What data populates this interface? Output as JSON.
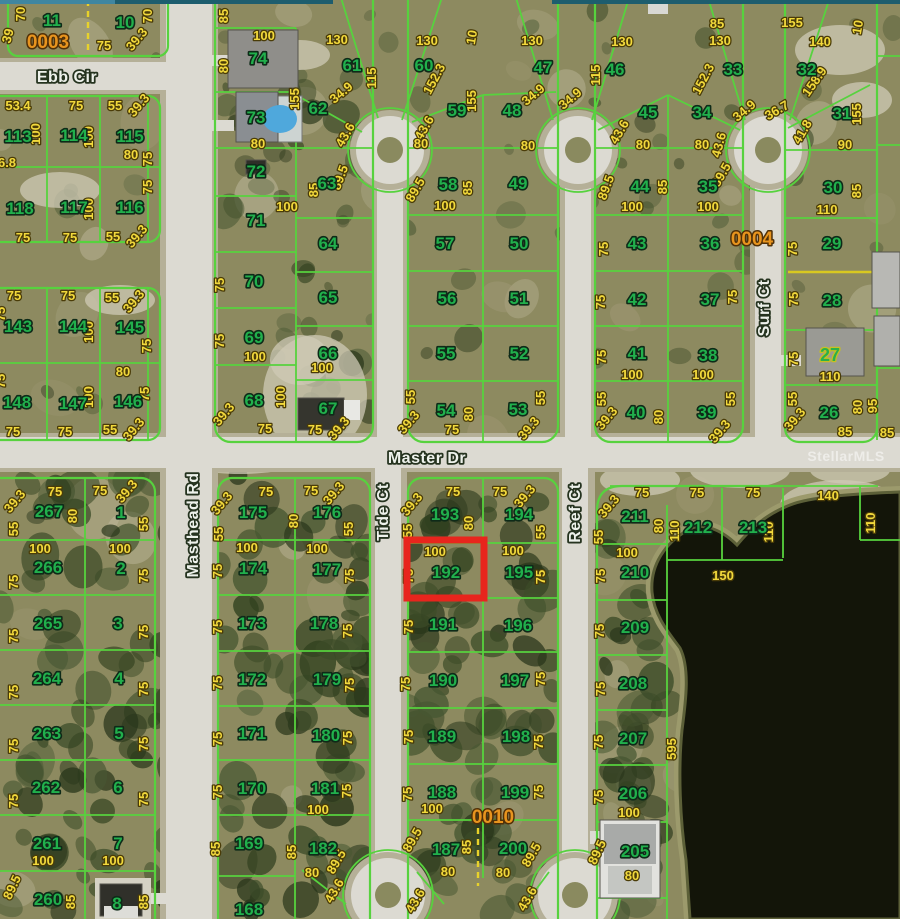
{
  "colors": {
    "lot_number": "#21b04c",
    "dimension": "#f2d93c",
    "street_label": "#eef2ec",
    "section_label": "#e8941e",
    "parcel_line": "#57d23e",
    "highlight": "#e8251d",
    "road": "#dcdad2",
    "water": "#131509",
    "ground": "#8d8a60",
    "pool": "#4fa8dc"
  },
  "watermark": {
    "text": "StellarMLS",
    "x": 846,
    "y": 461
  },
  "highlight": {
    "lot": "192",
    "x": 407,
    "y": 540,
    "w": 77,
    "h": 58
  },
  "streets": [
    {
      "name": "Ebb Cir",
      "x": 67,
      "y": 82,
      "rot": 0,
      "size": 17
    },
    {
      "name": "Masthead Rd",
      "x": 198,
      "y": 525,
      "rot": -90,
      "size": 16
    },
    {
      "name": "Master Dr",
      "x": 427,
      "y": 463,
      "rot": 0,
      "size": 18
    },
    {
      "name": "Tide Ct",
      "x": 388,
      "y": 512,
      "rot": -90,
      "size": 15
    },
    {
      "name": "Reef Ct",
      "x": 580,
      "y": 513,
      "rot": -90,
      "size": 15
    },
    {
      "name": "Surf Ct",
      "x": 769,
      "y": 308,
      "rot": -90,
      "size": 15
    }
  ],
  "sections": [
    [
      "0003",
      48,
      48
    ],
    [
      "0004",
      752,
      245
    ],
    [
      "0010",
      493,
      823
    ]
  ],
  "lots": [
    [
      "11",
      52,
      26
    ],
    [
      "10",
      125,
      28
    ],
    [
      "113",
      18,
      142
    ],
    [
      "114",
      74,
      141
    ],
    [
      "115",
      130,
      142
    ],
    [
      "118",
      20,
      214
    ],
    [
      "117",
      74,
      213
    ],
    [
      "116",
      130,
      213
    ],
    [
      "143",
      18,
      332
    ],
    [
      "144",
      73,
      332
    ],
    [
      "145",
      130,
      333
    ],
    [
      "148",
      17,
      408
    ],
    [
      "147",
      73,
      409
    ],
    [
      "146",
      128,
      407
    ],
    [
      "74",
      258,
      64
    ],
    [
      "73",
      256,
      123
    ],
    [
      "72",
      256,
      177
    ],
    [
      "71",
      256,
      226
    ],
    [
      "70",
      254,
      287
    ],
    [
      "69",
      254,
      343
    ],
    [
      "68",
      254,
      406
    ],
    [
      "61",
      352,
      71
    ],
    [
      "62",
      318,
      114
    ],
    [
      "63",
      327,
      189
    ],
    [
      "64",
      328,
      249
    ],
    [
      "65",
      328,
      303
    ],
    [
      "66",
      328,
      359
    ],
    [
      "67",
      328,
      414
    ],
    [
      "60",
      424,
      71
    ],
    [
      "59",
      457,
      116
    ],
    [
      "58",
      448,
      190
    ],
    [
      "57",
      445,
      249
    ],
    [
      "56",
      447,
      304
    ],
    [
      "55",
      446,
      359
    ],
    [
      "54",
      446,
      416
    ],
    [
      "47",
      543,
      73
    ],
    [
      "48",
      512,
      116
    ],
    [
      "49",
      518,
      189
    ],
    [
      "50",
      519,
      249
    ],
    [
      "51",
      519,
      304
    ],
    [
      "52",
      519,
      359
    ],
    [
      "53",
      518,
      415
    ],
    [
      "46",
      615,
      75
    ],
    [
      "45",
      648,
      118
    ],
    [
      "44",
      640,
      192
    ],
    [
      "43",
      637,
      249
    ],
    [
      "42",
      637,
      305
    ],
    [
      "41",
      637,
      359
    ],
    [
      "40",
      636,
      418
    ],
    [
      "33",
      733,
      75
    ],
    [
      "34",
      702,
      118
    ],
    [
      "35",
      708,
      192
    ],
    [
      "36",
      710,
      249
    ],
    [
      "37",
      710,
      305
    ],
    [
      "38",
      708,
      361
    ],
    [
      "39",
      707,
      418
    ],
    [
      "32",
      807,
      75
    ],
    [
      "31",
      842,
      119
    ],
    [
      "30",
      833,
      193
    ],
    [
      "29",
      832,
      249
    ],
    [
      "28",
      832,
      306
    ],
    [
      "26",
      829,
      418
    ],
    [
      "267",
      49,
      517
    ],
    [
      "266",
      48,
      573
    ],
    [
      "265",
      48,
      629
    ],
    [
      "264",
      47,
      684
    ],
    [
      "263",
      47,
      739
    ],
    [
      "262",
      46,
      793
    ],
    [
      "261",
      47,
      849
    ],
    [
      "260",
      48,
      905
    ],
    [
      "1",
      121,
      518
    ],
    [
      "2",
      121,
      574
    ],
    [
      "3",
      118,
      629
    ],
    [
      "4",
      119,
      684
    ],
    [
      "5",
      119,
      739
    ],
    [
      "6",
      118,
      793
    ],
    [
      "7",
      118,
      849
    ],
    [
      "8",
      117,
      909
    ],
    [
      "175",
      253,
      518
    ],
    [
      "174",
      253,
      574
    ],
    [
      "173",
      252,
      629
    ],
    [
      "172",
      252,
      685
    ],
    [
      "171",
      252,
      739
    ],
    [
      "170",
      252,
      794
    ],
    [
      "169",
      249,
      849
    ],
    [
      "168",
      249,
      915
    ],
    [
      "176",
      327,
      518
    ],
    [
      "177",
      327,
      575
    ],
    [
      "178",
      324,
      629
    ],
    [
      "179",
      327,
      685
    ],
    [
      "180",
      326,
      741
    ],
    [
      "181",
      325,
      794
    ],
    [
      "182",
      323,
      854
    ],
    [
      "193",
      445,
      520
    ],
    [
      "192",
      446,
      578
    ],
    [
      "191",
      443,
      630
    ],
    [
      "190",
      443,
      686
    ],
    [
      "189",
      442,
      742
    ],
    [
      "188",
      442,
      798
    ],
    [
      "187",
      446,
      855
    ],
    [
      "194",
      519,
      520
    ],
    [
      "195",
      519,
      578
    ],
    [
      "196",
      518,
      631
    ],
    [
      "197",
      515,
      686
    ],
    [
      "198",
      516,
      742
    ],
    [
      "199",
      515,
      798
    ],
    [
      "200",
      513,
      854
    ],
    [
      "211",
      635,
      522
    ],
    [
      "210",
      635,
      578
    ],
    [
      "209",
      635,
      633
    ],
    [
      "208",
      633,
      689
    ],
    [
      "207",
      633,
      744
    ],
    [
      "206",
      633,
      799
    ],
    [
      "205",
      635,
      857
    ],
    [
      "212",
      698,
      533
    ],
    [
      "213",
      753,
      533
    ]
  ],
  "lots_special": [
    [
      "27",
      830,
      361
    ]
  ],
  "dims": [
    [
      "70",
      25,
      14,
      -90
    ],
    [
      "70",
      152,
      16,
      -90
    ],
    [
      "75",
      104,
      50
    ],
    [
      "39.3",
      140,
      42,
      -50
    ],
    [
      "39",
      12,
      37,
      -75
    ],
    [
      "85",
      228,
      16,
      -90
    ],
    [
      "100",
      264,
      40
    ],
    [
      "80",
      228,
      66,
      -90
    ],
    [
      "155",
      299,
      99,
      -90
    ],
    [
      "130",
      337,
      44
    ],
    [
      "130",
      427,
      45
    ],
    [
      "130",
      532,
      45
    ],
    [
      "130",
      622,
      46
    ],
    [
      "130",
      720,
      45
    ],
    [
      "140",
      820,
      46
    ],
    [
      "115",
      376,
      78,
      -90
    ],
    [
      "115",
      600,
      75,
      -90
    ],
    [
      "10",
      476,
      38,
      -80
    ],
    [
      "10",
      862,
      28,
      -80
    ],
    [
      "85",
      717,
      28
    ],
    [
      "155",
      792,
      27
    ],
    [
      "152.3",
      438,
      81,
      -62
    ],
    [
      "152.3",
      707,
      81,
      -62
    ],
    [
      "158.9",
      818,
      84,
      -55
    ],
    [
      "155",
      476,
      101,
      -90
    ],
    [
      "155",
      861,
      114,
      -90
    ],
    [
      "34.9",
      344,
      96,
      -40
    ],
    [
      "34.9",
      536,
      98,
      -40
    ],
    [
      "34.9",
      573,
      102,
      -40
    ],
    [
      "34.9",
      747,
      114,
      -40
    ],
    [
      "36.7",
      779,
      114,
      -30
    ],
    [
      "41.8",
      806,
      134,
      -60
    ],
    [
      "43.6",
      349,
      137,
      -60
    ],
    [
      "43.6",
      428,
      130,
      -60
    ],
    [
      "43.6",
      623,
      134,
      -60
    ],
    [
      "43.6",
      723,
      146,
      -75
    ],
    [
      "80",
      258,
      148
    ],
    [
      "80",
      421,
      148
    ],
    [
      "80",
      528,
      150
    ],
    [
      "80",
      643,
      149
    ],
    [
      "80",
      702,
      149
    ],
    [
      "90",
      845,
      149
    ],
    [
      "89.5",
      344,
      179,
      -70
    ],
    [
      "89.5",
      419,
      192,
      -60
    ],
    [
      "89.5",
      610,
      189,
      -70
    ],
    [
      "89.5",
      725,
      177,
      -60
    ],
    [
      "85",
      318,
      190,
      -90
    ],
    [
      "85",
      472,
      188,
      -90
    ],
    [
      "85",
      667,
      187,
      -90
    ],
    [
      "85",
      861,
      191,
      -90
    ],
    [
      "100",
      287,
      211
    ],
    [
      "100",
      445,
      210
    ],
    [
      "100",
      632,
      211
    ],
    [
      "100",
      708,
      211
    ],
    [
      "110",
      827,
      214
    ],
    [
      "53.4",
      18,
      110
    ],
    [
      "75",
      76,
      110
    ],
    [
      "55",
      115,
      110
    ],
    [
      "39.3",
      142,
      108,
      -50
    ],
    [
      "100",
      40,
      134,
      -90
    ],
    [
      "100",
      93,
      137,
      -90
    ],
    [
      "80",
      131,
      159
    ],
    [
      "75",
      152,
      159,
      -90
    ],
    [
      "6.8",
      7,
      167
    ],
    [
      "100",
      93,
      209,
      -90
    ],
    [
      "75",
      152,
      187,
      -90
    ],
    [
      "75",
      23,
      242
    ],
    [
      "75",
      70,
      242
    ],
    [
      "55",
      113,
      241
    ],
    [
      "39.3",
      140,
      239,
      -50
    ],
    [
      "75",
      14,
      300
    ],
    [
      "75",
      68,
      300
    ],
    [
      "55",
      112,
      302
    ],
    [
      "39.3",
      137,
      304,
      -50
    ],
    [
      "100",
      93,
      332,
      -90
    ],
    [
      "75",
      151,
      346,
      -90
    ],
    [
      "80",
      123,
      376
    ],
    [
      "100",
      93,
      397,
      -90
    ],
    [
      "75",
      149,
      394,
      -90
    ],
    [
      "75",
      13,
      436
    ],
    [
      "75",
      65,
      436
    ],
    [
      "55",
      110,
      434
    ],
    [
      "39.3",
      137,
      432,
      -50
    ],
    [
      "75",
      5,
      314,
      -90
    ],
    [
      "75",
      5,
      381,
      -90
    ],
    [
      "100",
      255,
      361
    ],
    [
      "75",
      224,
      341,
      -90
    ],
    [
      "75",
      224,
      285,
      -90
    ],
    [
      "100",
      322,
      372
    ],
    [
      "100",
      285,
      397,
      -90
    ],
    [
      "75",
      315,
      434
    ],
    [
      "39.3",
      342,
      431,
      -50
    ],
    [
      "39.3",
      227,
      417,
      -50
    ],
    [
      "75",
      265,
      433
    ],
    [
      "55",
      415,
      397,
      -90
    ],
    [
      "80",
      473,
      414,
      -90
    ],
    [
      "55",
      545,
      398,
      -90
    ],
    [
      "39.3",
      532,
      431,
      -50
    ],
    [
      "75",
      452,
      434
    ],
    [
      "39.3",
      412,
      425,
      -50
    ],
    [
      "75",
      608,
      249,
      -90
    ],
    [
      "75",
      605,
      302,
      -90
    ],
    [
      "75",
      606,
      357,
      -90
    ],
    [
      "55",
      606,
      399,
      -90
    ],
    [
      "39.3",
      610,
      421,
      -50
    ],
    [
      "100",
      632,
      379
    ],
    [
      "80",
      663,
      417,
      -90
    ],
    [
      "100",
      703,
      379
    ],
    [
      "55",
      735,
      399,
      -90
    ],
    [
      "39.3",
      723,
      434,
      -50
    ],
    [
      "75",
      737,
      297,
      -90
    ],
    [
      "75",
      797,
      249,
      -90
    ],
    [
      "75",
      798,
      299,
      -90
    ],
    [
      "75",
      798,
      359,
      -90
    ],
    [
      "55",
      797,
      399,
      -90
    ],
    [
      "39.3",
      798,
      422,
      -50
    ],
    [
      "110",
      830,
      381
    ],
    [
      "80",
      862,
      407,
      -90
    ],
    [
      "95",
      877,
      406,
      -90
    ],
    [
      "85",
      845,
      436
    ],
    [
      "85",
      887,
      437
    ],
    [
      "75",
      55,
      496
    ],
    [
      "75",
      100,
      495
    ],
    [
      "39.3",
      130,
      494,
      -50
    ],
    [
      "39.3",
      18,
      504,
      -50
    ],
    [
      "80",
      77,
      516,
      -90
    ],
    [
      "55",
      148,
      524,
      -90
    ],
    [
      "55",
      18,
      529,
      -90
    ],
    [
      "100",
      40,
      553
    ],
    [
      "100",
      120,
      553
    ],
    [
      "75",
      18,
      582,
      -90
    ],
    [
      "75",
      148,
      576,
      -90
    ],
    [
      "75",
      18,
      636,
      -90
    ],
    [
      "75",
      148,
      632,
      -90
    ],
    [
      "75",
      18,
      692,
      -90
    ],
    [
      "75",
      148,
      689,
      -90
    ],
    [
      "75",
      18,
      746,
      -90
    ],
    [
      "75",
      148,
      744,
      -90
    ],
    [
      "75",
      18,
      801,
      -90
    ],
    [
      "75",
      148,
      799,
      -90
    ],
    [
      "100",
      43,
      865
    ],
    [
      "100",
      113,
      865
    ],
    [
      "85",
      75,
      902,
      -90
    ],
    [
      "85",
      148,
      902,
      -90
    ],
    [
      "89.5",
      16,
      889,
      -65
    ],
    [
      "75",
      266,
      496
    ],
    [
      "75",
      311,
      495
    ],
    [
      "39.3",
      337,
      496,
      -50
    ],
    [
      "39.3",
      225,
      506,
      -50
    ],
    [
      "80",
      298,
      521,
      -90
    ],
    [
      "55",
      223,
      534,
      -90
    ],
    [
      "55",
      353,
      529,
      -90
    ],
    [
      "100",
      247,
      552
    ],
    [
      "100",
      317,
      553
    ],
    [
      "75",
      222,
      571,
      -90
    ],
    [
      "75",
      354,
      576,
      -90
    ],
    [
      "75",
      222,
      627,
      -90
    ],
    [
      "75",
      352,
      631,
      -90
    ],
    [
      "75",
      222,
      683,
      -90
    ],
    [
      "75",
      354,
      685,
      -90
    ],
    [
      "75",
      222,
      739,
      -90
    ],
    [
      "75",
      352,
      738,
      -90
    ],
    [
      "75",
      222,
      792,
      -90
    ],
    [
      "75",
      351,
      791,
      -90
    ],
    [
      "100",
      318,
      814
    ],
    [
      "85",
      220,
      849,
      -90
    ],
    [
      "85",
      296,
      852,
      -90
    ],
    [
      "89.5",
      340,
      864,
      -60
    ],
    [
      "80",
      312,
      877
    ],
    [
      "43.6",
      338,
      893,
      -60
    ],
    [
      "75",
      453,
      496
    ],
    [
      "75",
      500,
      496
    ],
    [
      "39.3",
      415,
      507,
      -50
    ],
    [
      "39.3",
      528,
      499,
      -50
    ],
    [
      "80",
      473,
      523,
      -90
    ],
    [
      "55",
      412,
      531,
      -90
    ],
    [
      "55",
      545,
      532,
      -90
    ],
    [
      "100",
      435,
      556
    ],
    [
      "100",
      513,
      555
    ],
    [
      "75",
      413,
      576,
      -90
    ],
    [
      "75",
      545,
      577,
      -90
    ],
    [
      "75",
      413,
      627,
      -90
    ],
    [
      "75",
      410,
      684,
      -90
    ],
    [
      "75",
      545,
      679,
      -90
    ],
    [
      "75",
      413,
      737,
      -90
    ],
    [
      "75",
      543,
      742,
      -90
    ],
    [
      "75",
      412,
      794,
      -90
    ],
    [
      "75",
      543,
      792,
      -90
    ],
    [
      "100",
      432,
      813
    ],
    [
      "89.5",
      416,
      842,
      -60
    ],
    [
      "85",
      471,
      847,
      -90
    ],
    [
      "80",
      448,
      876
    ],
    [
      "80",
      503,
      877
    ],
    [
      "43.6",
      419,
      903,
      -60
    ],
    [
      "89.5",
      535,
      857,
      -60
    ],
    [
      "43.6",
      531,
      901,
      -60
    ],
    [
      "75",
      642,
      497
    ],
    [
      "75",
      697,
      497
    ],
    [
      "75",
      753,
      497
    ],
    [
      "39.3",
      612,
      509,
      -50
    ],
    [
      "55",
      603,
      537,
      -90
    ],
    [
      "80",
      663,
      526,
      -90
    ],
    [
      "110",
      679,
      531,
      -90
    ],
    [
      "110",
      773,
      532,
      -90
    ],
    [
      "110",
      875,
      523,
      -90
    ],
    [
      "140",
      828,
      500
    ],
    [
      "100",
      627,
      557
    ],
    [
      "75",
      605,
      576,
      -90
    ],
    [
      "150",
      723,
      580
    ],
    [
      "75",
      604,
      631,
      -90
    ],
    [
      "75",
      605,
      689,
      -90
    ],
    [
      "75",
      603,
      742,
      -90
    ],
    [
      "75",
      603,
      797,
      -90
    ],
    [
      "595",
      676,
      749,
      -90
    ],
    [
      "100",
      629,
      817
    ],
    [
      "89.5",
      601,
      854,
      -65
    ],
    [
      "80",
      632,
      880
    ]
  ]
}
